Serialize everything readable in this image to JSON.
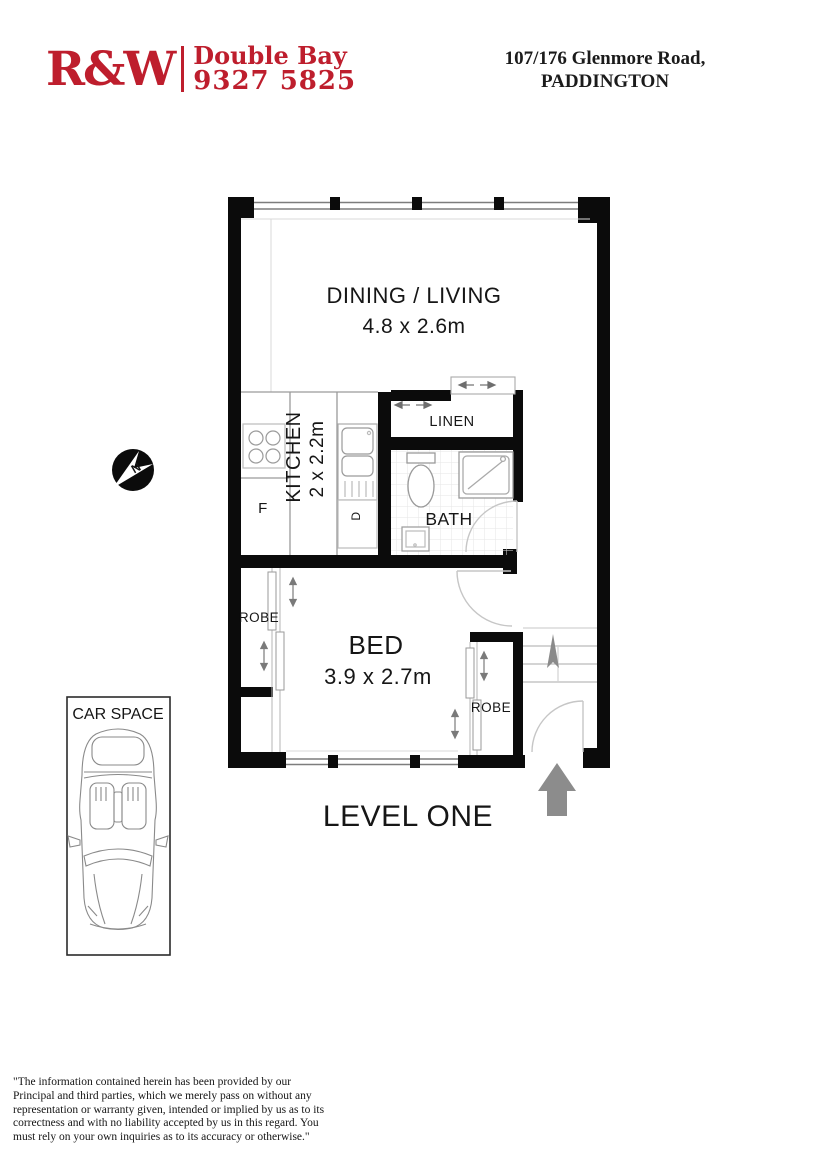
{
  "header": {
    "logo": {
      "initials": "R&W",
      "office": "Double Bay",
      "phone": "9327 5825",
      "brand_color": "#be1e2d"
    },
    "address": {
      "line1": "107/176 Glenmore Road,",
      "line2": "PADDINGTON"
    }
  },
  "floorplan": {
    "rooms": {
      "dining": {
        "label": "DINING / LIVING",
        "dims": "4.8 x 2.6m"
      },
      "kitchen": {
        "label": "KITCHEN",
        "dims": "2 x 2.2m"
      },
      "linen": {
        "label": "LINEN"
      },
      "bath": {
        "label": "BATH"
      },
      "bed": {
        "label": "BED",
        "dims": "3.9 x 2.7m"
      },
      "robe_left": {
        "label": "ROBE"
      },
      "robe_right": {
        "label": "ROBE"
      }
    },
    "appliances": {
      "fridge": "F",
      "dishwasher": "D"
    },
    "compass_letter": "N",
    "level_label": "LEVEL ONE"
  },
  "car_space": {
    "label": "CAR SPACE"
  },
  "disclaimer": {
    "text": " \"The information contained herein has been provided by our Principal and third parties, which we merely pass on without any representation or warranty given, intended or implied by us as to its correctness and with no liability accepted by us in this regard. You must rely on your own inquiries as to its accuracy or otherwise.\""
  }
}
